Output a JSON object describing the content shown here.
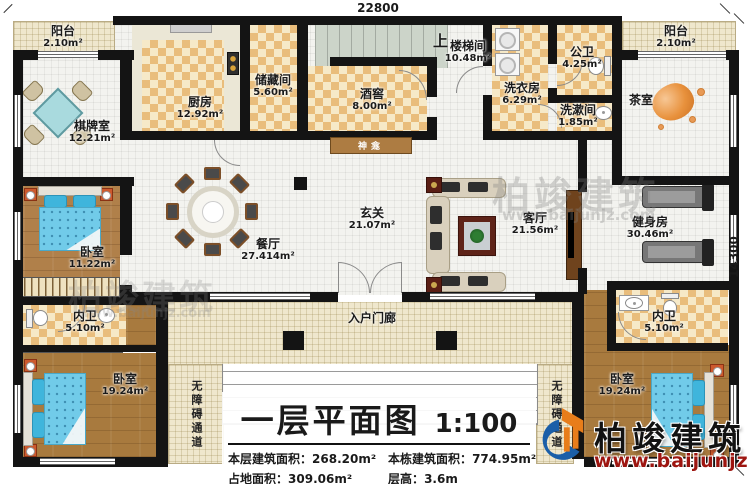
{
  "dimensions": {
    "top": "22800",
    "right": "14300"
  },
  "rooms": {
    "balcony_tl": {
      "name": "阳台",
      "area": "2.10m²"
    },
    "balcony_tr": {
      "name": "阳台",
      "area": "2.10m²"
    },
    "kitchen": {
      "name": "厨房",
      "area": "12.92m²"
    },
    "storage": {
      "name": "储藏间",
      "area": "5.60m²"
    },
    "stair": {
      "up": "上",
      "name": "楼梯间",
      "area": "10.48m²"
    },
    "wine": {
      "name": "酒窖",
      "area": "8.00m²"
    },
    "laundry": {
      "name": "洗衣房",
      "area": "6.29m²"
    },
    "pubbath": {
      "name": "公卫",
      "area": "4.25m²"
    },
    "washroom": {
      "name": "洗漱间",
      "area": "1.85m²"
    },
    "tearoom": {
      "name": "茶室"
    },
    "chess": {
      "name": "棋牌室",
      "area": "12.21m²"
    },
    "shrine": {
      "name": "神龛"
    },
    "dining": {
      "name": "餐厅",
      "area": "27.414m²"
    },
    "foyer": {
      "name": "玄关",
      "area": "21.07m²"
    },
    "living": {
      "name": "客厅",
      "area": "21.56m²"
    },
    "gym": {
      "name": "健身房",
      "area": "30.46m²"
    },
    "bedroom1": {
      "name": "卧室",
      "area": "11.22m²"
    },
    "bath_left": {
      "name": "内卫",
      "area": "5.10m²"
    },
    "bedroom2": {
      "name": "卧室",
      "area": "19.24m²"
    },
    "bath_right": {
      "name": "内卫",
      "area": "5.10m²"
    },
    "bedroom3": {
      "name": "卧室",
      "area": "19.24m²"
    },
    "porch": {
      "name": "入户门廊"
    },
    "ramp_left": {
      "name": "无障碍通道"
    },
    "ramp_right": {
      "name": "无障碍通道"
    }
  },
  "title_block": {
    "title": "一层平面图",
    "scale": "1:100",
    "stats": [
      {
        "label": "本层建筑面积：",
        "value": "268.20m²"
      },
      {
        "label": "本栋建筑面积：",
        "value": "774.95m²"
      },
      {
        "label": "占地面积：",
        "value": "309.06m²"
      },
      {
        "label": "层高：",
        "value": "3.6m"
      }
    ]
  },
  "branding": {
    "company": "柏竣建筑",
    "website": "www.baijunjz.com"
  }
}
